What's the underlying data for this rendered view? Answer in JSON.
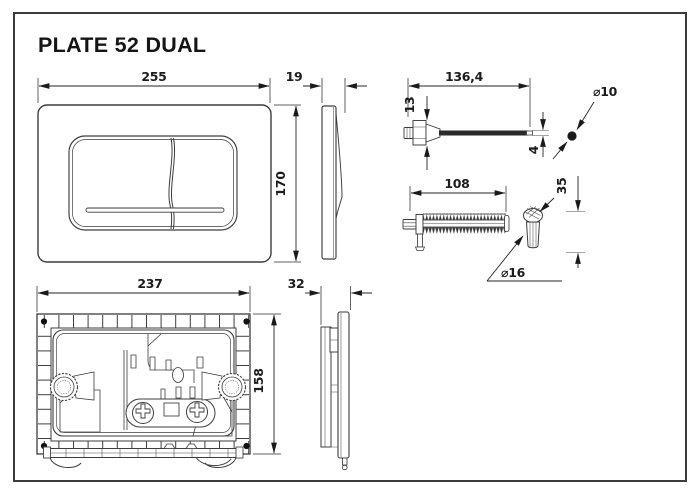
{
  "title": "PLATE 52 DUAL",
  "dimensions": {
    "plate_width": "255",
    "plate_depth": "19",
    "plate_height": "170",
    "rod_length": "136,4",
    "rod_head_height": "13",
    "rod_tip_diameter": "4",
    "rod_ball_diameter": "⌀10",
    "screw_length": "108",
    "knob_height": "35",
    "knob_diameter": "⌀16",
    "frame_width": "237",
    "frame_height": "158",
    "frame_depth": "32"
  }
}
